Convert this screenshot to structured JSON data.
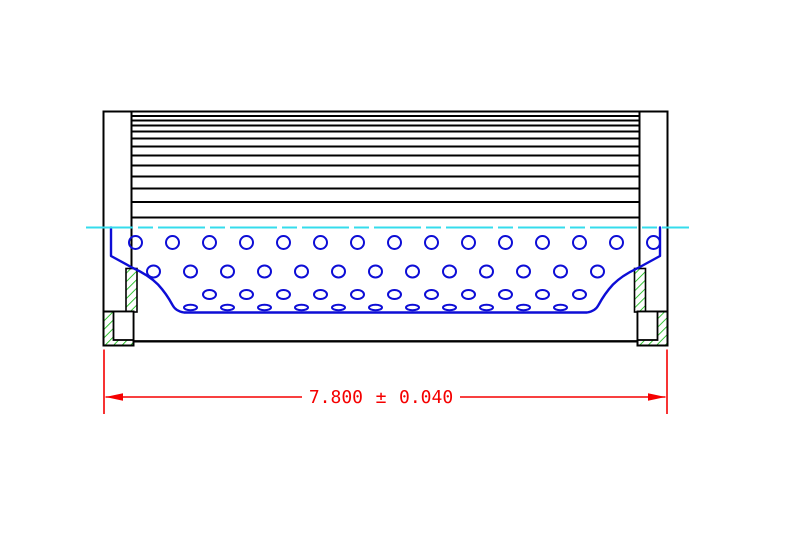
{
  "drawing": {
    "dimension": {
      "value": "7.800",
      "plus_minus": "±",
      "tolerance": "0.040"
    },
    "colors": {
      "outline": "#000000",
      "core_blue": "#0d0dd6",
      "centerline_cyan": "#35dcec",
      "gasket_hatch_green": "#00b400",
      "dimension_red": "#f50000",
      "background": "#ffffff"
    },
    "filter_media": {
      "x1": 131.5,
      "x2": 639.5,
      "top": 111.5,
      "bottom": 217.5,
      "line_ys": [
        116,
        120.5,
        125.5,
        131.5,
        138.5,
        146.5,
        155.5,
        165.5,
        176.5,
        188.5,
        202
      ]
    },
    "perforations": {
      "rows": [
        {
          "y": 242.5,
          "rx": 6.5,
          "ry": 6.5,
          "x0": 135.5,
          "step": 37,
          "count": 15
        },
        {
          "y": 271.5,
          "rx": 6.5,
          "ry": 6.0,
          "x0": 153.5,
          "step": 37,
          "count": 13
        },
        {
          "y": 294.5,
          "rx": 6.5,
          "ry": 4.5,
          "x0": 209.5,
          "step": 37,
          "count": 11
        },
        {
          "y": 307.5,
          "rx": 6.5,
          "ry": 2.8,
          "x0": 190.5,
          "step": 37,
          "count": 11
        }
      ]
    }
  }
}
